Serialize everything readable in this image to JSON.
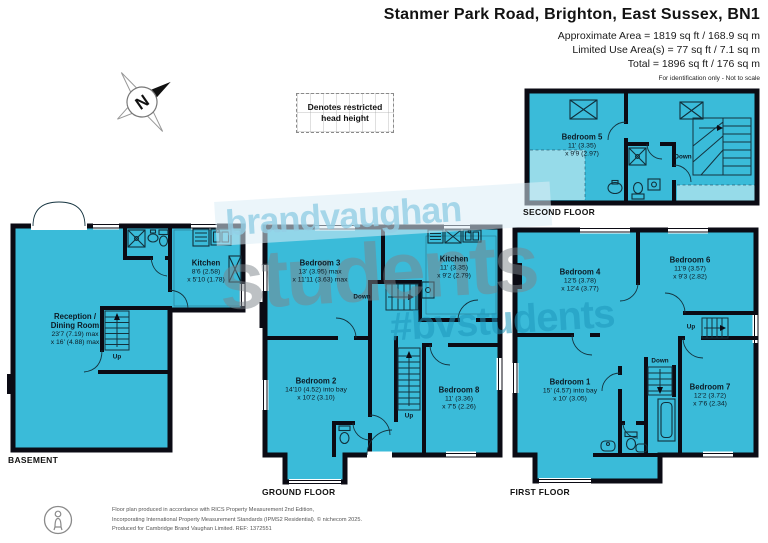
{
  "header": {
    "title": "Stanmer Park Road, Brighton, East Sussex, BN1",
    "area_lines": [
      "Approximate Area = 1819 sq ft / 168.9 sq m",
      "Limited Use Area(s) = 77 sq ft / 7.1 sq m",
      "Total = 1896 sq ft / 176 sq m"
    ],
    "disclaimer": "For identification only - Not to scale"
  },
  "legend": {
    "compass": "N",
    "restricted": "Denotes restricted head height"
  },
  "watermark": {
    "line1": "brandvaughan",
    "line2": "students",
    "line3": "#bvstudents"
  },
  "floors": {
    "basement": {
      "label": "BASEMENT",
      "rooms": [
        {
          "name": "Reception /\nDining Room",
          "dim1": "23'7 (7.19) max",
          "dim2": "x 16' (4.88) max"
        },
        {
          "name": "Kitchen",
          "dim1": "8'6 (2.58)",
          "dim2": "x 5'10 (1.78)"
        }
      ],
      "stairs": [
        "Up"
      ]
    },
    "ground": {
      "label": "GROUND FLOOR",
      "rooms": [
        {
          "name": "Bedroom 3",
          "dim1": "13' (3.95) max",
          "dim2": "x 11'11 (3.63) max"
        },
        {
          "name": "Kitchen",
          "dim1": "11' (3.35)",
          "dim2": "x 9'2 (2.79)"
        },
        {
          "name": "Bedroom 2",
          "dim1": "14'10 (4.52) into bay",
          "dim2": "x 10'2 (3.10)"
        },
        {
          "name": "Bedroom 8",
          "dim1": "11' (3.36)",
          "dim2": "x 7'5 (2.26)"
        }
      ],
      "stairs": [
        "Down",
        "Up"
      ]
    },
    "first": {
      "label": "FIRST FLOOR",
      "rooms": [
        {
          "name": "Bedroom 4",
          "dim1": "12'5 (3.78)",
          "dim2": "x 12'4 (3.77)"
        },
        {
          "name": "Bedroom 6",
          "dim1": "11'9 (3.57)",
          "dim2": "x 9'3 (2.82)"
        },
        {
          "name": "Bedroom 1",
          "dim1": "15' (4.57) into bay",
          "dim2": "x 10' (3.05)"
        },
        {
          "name": "Bedroom 7",
          "dim1": "12'2 (3.72)",
          "dim2": "x 7'6 (2.34)"
        }
      ],
      "stairs": [
        "Up",
        "Down"
      ]
    },
    "second": {
      "label": "SECOND FLOOR",
      "rooms": [
        {
          "name": "Bedroom 5",
          "dim1": "11' (3.35)",
          "dim2": "x 9'9 (2.97)"
        }
      ],
      "stairs": [
        "Down"
      ]
    }
  },
  "footer": {
    "lines": [
      "Floor plan produced in accordance with RICS Property Measurement 2nd Edition,",
      "Incorporating International Property Measurement Standards (IPMS2 Residential).  © nichecom 2025.",
      "Produced for Cambridge Brand Vaughan Limited.   REF:  1372551"
    ]
  },
  "colors": {
    "room_fill": "#3abbd9",
    "room_fill_restricted": "#96dbe9",
    "wall": "#0b0b14",
    "watermark_blue": "#94cee5",
    "watermark_gray": "#7c838a",
    "watermark_teal": "#1e98bc"
  }
}
